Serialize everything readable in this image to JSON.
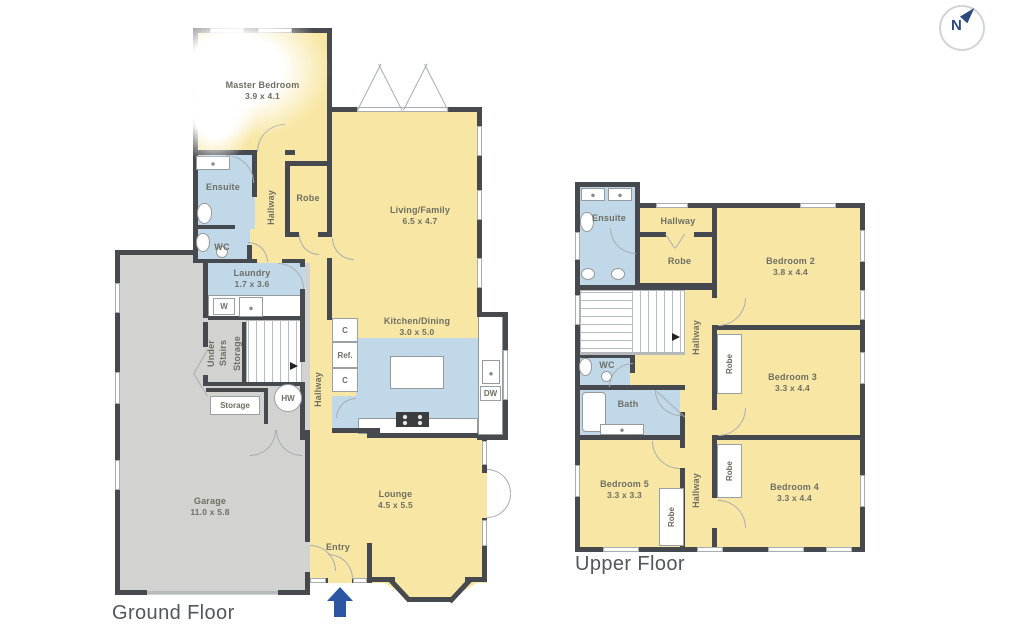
{
  "meta": {
    "compass_letter": "N"
  },
  "colors": {
    "room_yellow": "#f8e7a4",
    "wet_area_blue": "#c0d8e8",
    "garage_gray": "#d2d2d0",
    "wall": "#46494d",
    "label_text": "#6e6e63",
    "accent_navy": "#2a56a4"
  },
  "floors": {
    "ground": {
      "title": "Ground Floor",
      "rooms": {
        "master_bedroom": {
          "name": "Master Bedroom",
          "dims": "3.9 x 4.1"
        },
        "ensuite": {
          "name": "Ensuite"
        },
        "wc": {
          "name": "WC"
        },
        "hallway": {
          "name": "Hallway"
        },
        "robe": {
          "name": "Robe"
        },
        "living_family": {
          "name": "Living/Family",
          "dims": "6.5 x 4.7"
        },
        "laundry": {
          "name": "Laundry",
          "dims": "1.7 x 3.6"
        },
        "kitchen_dining": {
          "name": "Kitchen/Dining",
          "dims": "3.0 x 5.0"
        },
        "hallway2": {
          "name": "Hallway"
        },
        "under_stairs": {
          "line1": "Under Stairs",
          "line2": "Storage"
        },
        "storage": {
          "name": "Storage"
        },
        "garage": {
          "name": "Garage",
          "dims": "11.0 x 5.8"
        },
        "lounge": {
          "name": "Lounge",
          "dims": "4.5 x 5.5"
        },
        "entry": {
          "name": "Entry"
        }
      },
      "fixtures": {
        "washer": "W",
        "cupboard_top": "C",
        "fridge": "Ref.",
        "cupboard_bottom": "C",
        "pantry": "P",
        "dishwasher": "DW",
        "hot_water": "HW"
      }
    },
    "upper": {
      "title": "Upper Floor",
      "rooms": {
        "ensuite": {
          "name": "Ensuite"
        },
        "hallway_top": {
          "name": "Hallway"
        },
        "robe": {
          "name": "Robe"
        },
        "bedroom2": {
          "name": "Bedroom 2",
          "dims": "3.8 x 4.4"
        },
        "wc": {
          "name": "WC"
        },
        "bath": {
          "name": "Bath"
        },
        "hallway_mid": {
          "name": "Hallway"
        },
        "hallway_bottom": {
          "name": "Hallway"
        },
        "bedroom3": {
          "name": "Bedroom 3",
          "dims": "3.3 x 4.4"
        },
        "robe_bed3": {
          "name": "Robe"
        },
        "bedroom4": {
          "name": "Bedroom 4",
          "dims": "3.3 x 4.4"
        },
        "robe_bed4": {
          "name": "Robe"
        },
        "bedroom5": {
          "name": "Bedroom 5",
          "dims": "3.3 x 3.3"
        },
        "robe_bed5": {
          "name": "Robe"
        }
      }
    }
  }
}
